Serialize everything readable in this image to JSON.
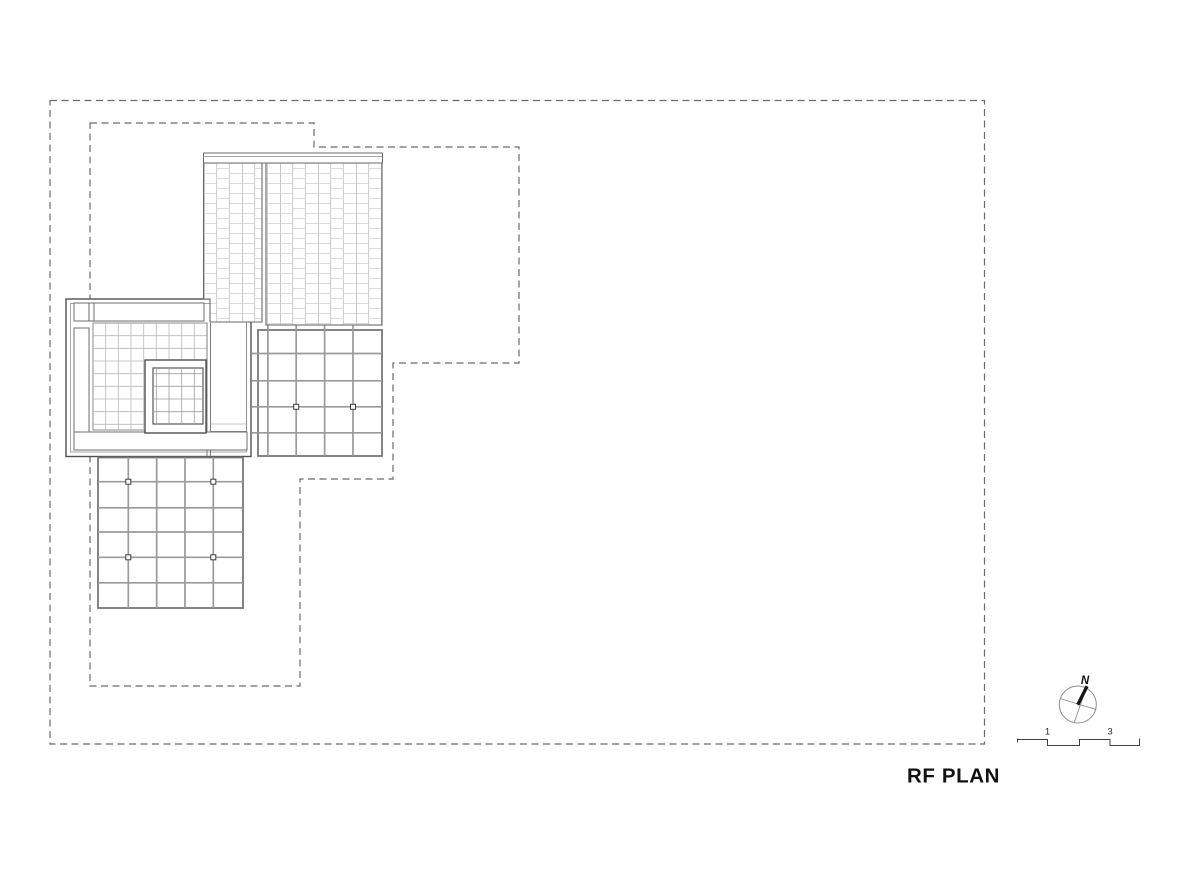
{
  "drawing": {
    "title": "RF PLAN",
    "sheet_background": "#ffffff",
    "north_indicator": {
      "label": "N"
    },
    "scale_bar": {
      "tick_labels": [
        "1",
        "3"
      ]
    },
    "colors": {
      "boundary_dash": "#6a6a6a",
      "outline_dark": "#4f4f4f",
      "outline_mid": "#6c6c6c",
      "grid_line": "#9a9a9a",
      "grid_border": "#777777",
      "mesh_line": "#b9b9b9",
      "brick_joint": "#cfcfcf",
      "brick_vertical": "#bfbfbf",
      "brick_accent": "#8f8f8f",
      "text": "#121212"
    },
    "site_boundary": {
      "x": 50,
      "y": 100.5,
      "width": 934.5,
      "height": 643.5,
      "line_style": "dashed"
    },
    "setback_boundary_points": "90,123 314,123 314,147 519,147 519,363 393,363 393,479 300,479 300,686 90,686",
    "roof_sections": [
      {
        "name": "north-brick-hatched-roof-left",
        "hatch": "running-bond"
      },
      {
        "name": "north-brick-hatched-roof-right",
        "hatch": "running-bond"
      },
      {
        "name": "west-pavilion-roof-with-skylight",
        "hatch": "fine-mesh"
      },
      {
        "name": "east-coffer-grid-roof",
        "cells": "4x5",
        "joint_markers": 2
      },
      {
        "name": "south-coffer-grid-roof",
        "cells": "5x6",
        "joint_markers": 4
      }
    ]
  }
}
